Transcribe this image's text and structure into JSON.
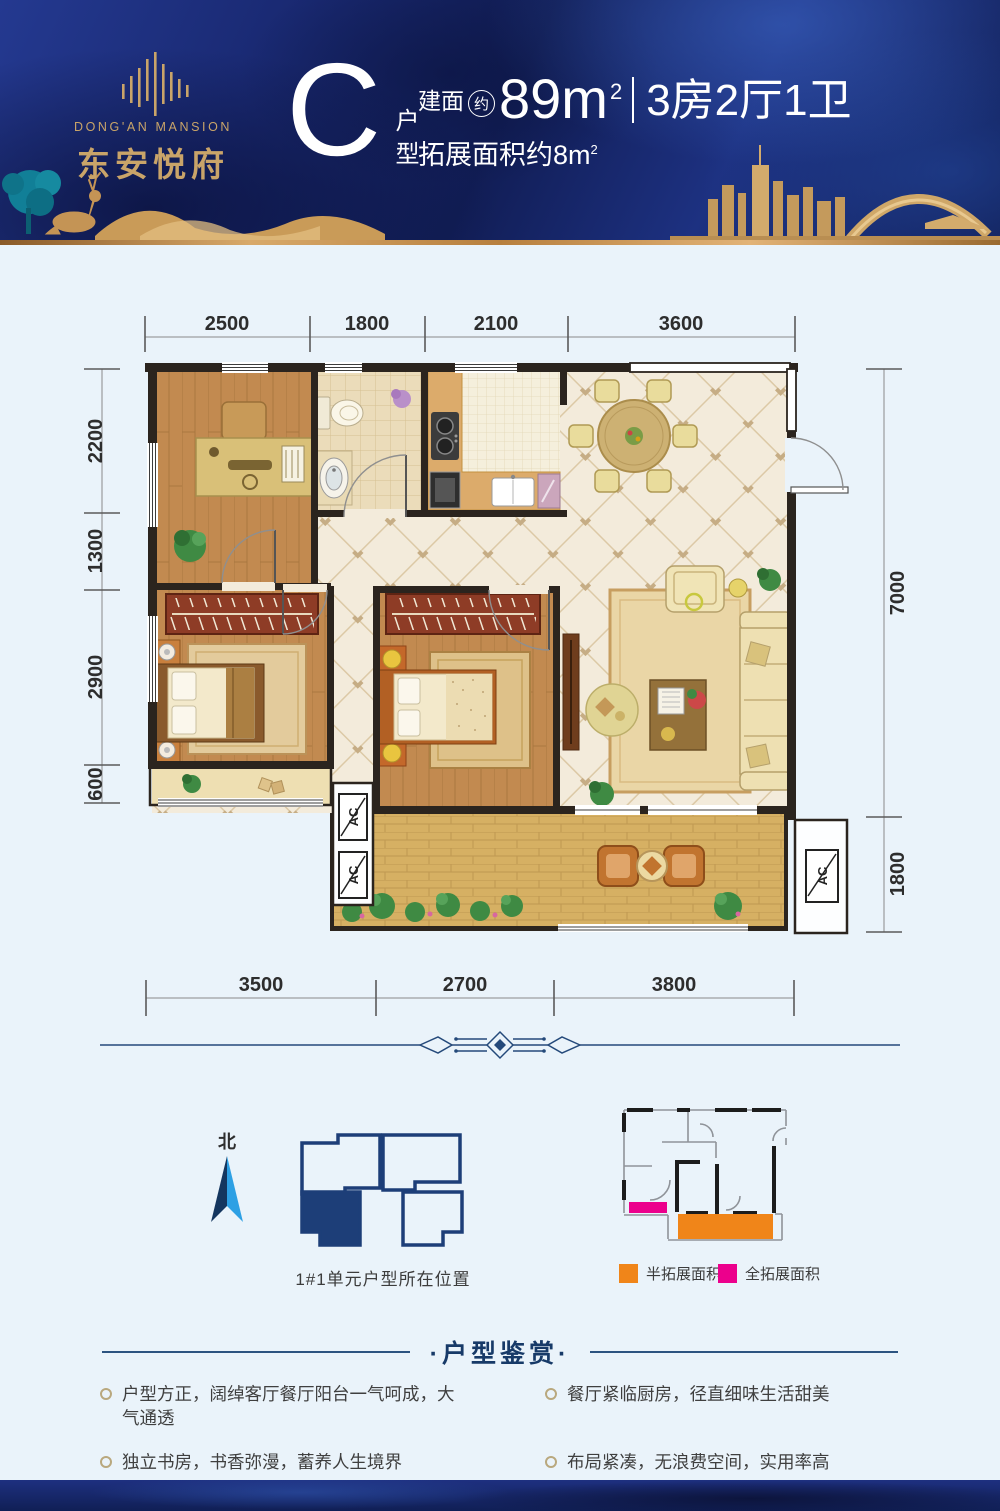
{
  "header": {
    "brand_en": "DONG'AN MANSION",
    "brand_cn": "东安悦府",
    "unit_letter": "C",
    "unit_type": "户型",
    "area_label": "建面",
    "area_approx": "约",
    "area_value": "89m",
    "area_sup": "2",
    "rooms": "3房2厅1卫",
    "expand_label": "拓展面积约8m",
    "expand_sup": "2"
  },
  "plan": {
    "dims_top": [
      "2500",
      "1800",
      "2100",
      "3600"
    ],
    "dims_left": [
      "2200",
      "1300",
      "2900",
      "600"
    ],
    "dims_right": [
      "7000",
      "1800"
    ],
    "dims_bottom": [
      "3500",
      "2700",
      "3800"
    ],
    "ac_label": "AC"
  },
  "locator": {
    "north_label": "北",
    "caption": "1#1单元户型所在位置"
  },
  "legend": {
    "half_label": "半拓展面积",
    "full_label": "全拓展面积"
  },
  "review": {
    "title": "·户型鉴赏·",
    "items": [
      "户型方正，阔绰客厅餐厅阳台一气呵成，大气通透",
      "餐厅紧临厨房，径直细味生活甜美",
      "独立书房，书香弥漫，蓄养人生境界",
      "布局紧凑，无浪费空间，实用率高"
    ]
  },
  "colors": {
    "navy": "#1D3E78",
    "gold": "#C9A469",
    "accent_orange": "#F08519",
    "accent_magenta": "#EC008C",
    "north_dark": "#14365F",
    "north_light": "#2DA0E4"
  }
}
